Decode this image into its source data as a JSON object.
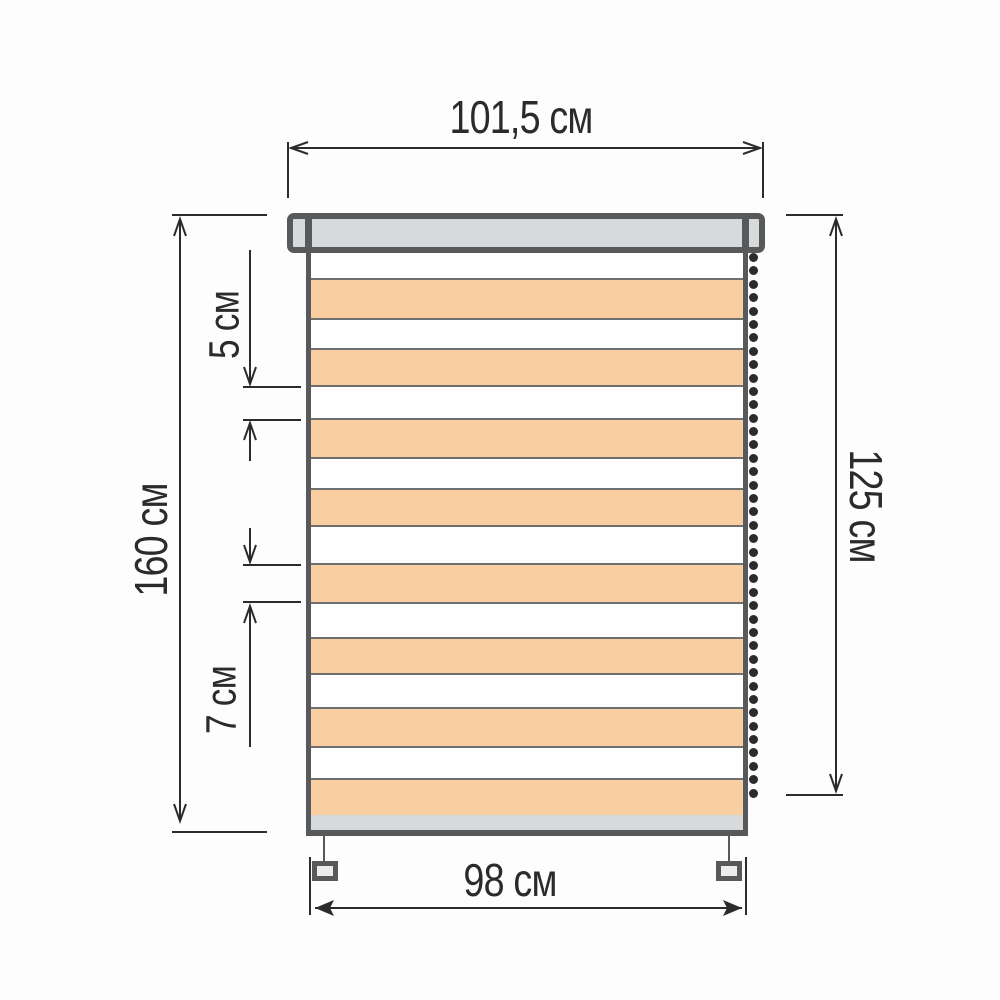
{
  "dimensions": {
    "top_width": "101,5 см",
    "left_height": "160 см",
    "right_height": "125 см",
    "bottom_width": "98 см",
    "transparent_stripe": "5 см",
    "fabric_stripe": "7 см"
  },
  "colors": {
    "fabric_stripe": "#f9cfa2",
    "transparent_stripe": "#fefefe",
    "hardware_fill": "#d8d9da",
    "outline": "#58595b",
    "dimension_lines": "#2b2b2d"
  },
  "blind": {
    "stripes": [
      {
        "color": "white",
        "h": 27
      },
      {
        "color": "orange",
        "h": 40
      },
      {
        "color": "white",
        "h": 30
      },
      {
        "color": "orange",
        "h": 37
      },
      {
        "color": "white",
        "h": 33
      },
      {
        "color": "orange",
        "h": 39
      },
      {
        "color": "white",
        "h": 31
      },
      {
        "color": "orange",
        "h": 37
      },
      {
        "color": "white",
        "h": 38
      },
      {
        "color": "orange",
        "h": 39
      },
      {
        "color": "white",
        "h": 35
      },
      {
        "color": "orange",
        "h": 36
      },
      {
        "color": "white",
        "h": 34
      },
      {
        "color": "orange",
        "h": 39
      },
      {
        "color": "white",
        "h": 32
      },
      {
        "color": "orange",
        "h": 36
      }
    ],
    "chain_beads": 41
  }
}
